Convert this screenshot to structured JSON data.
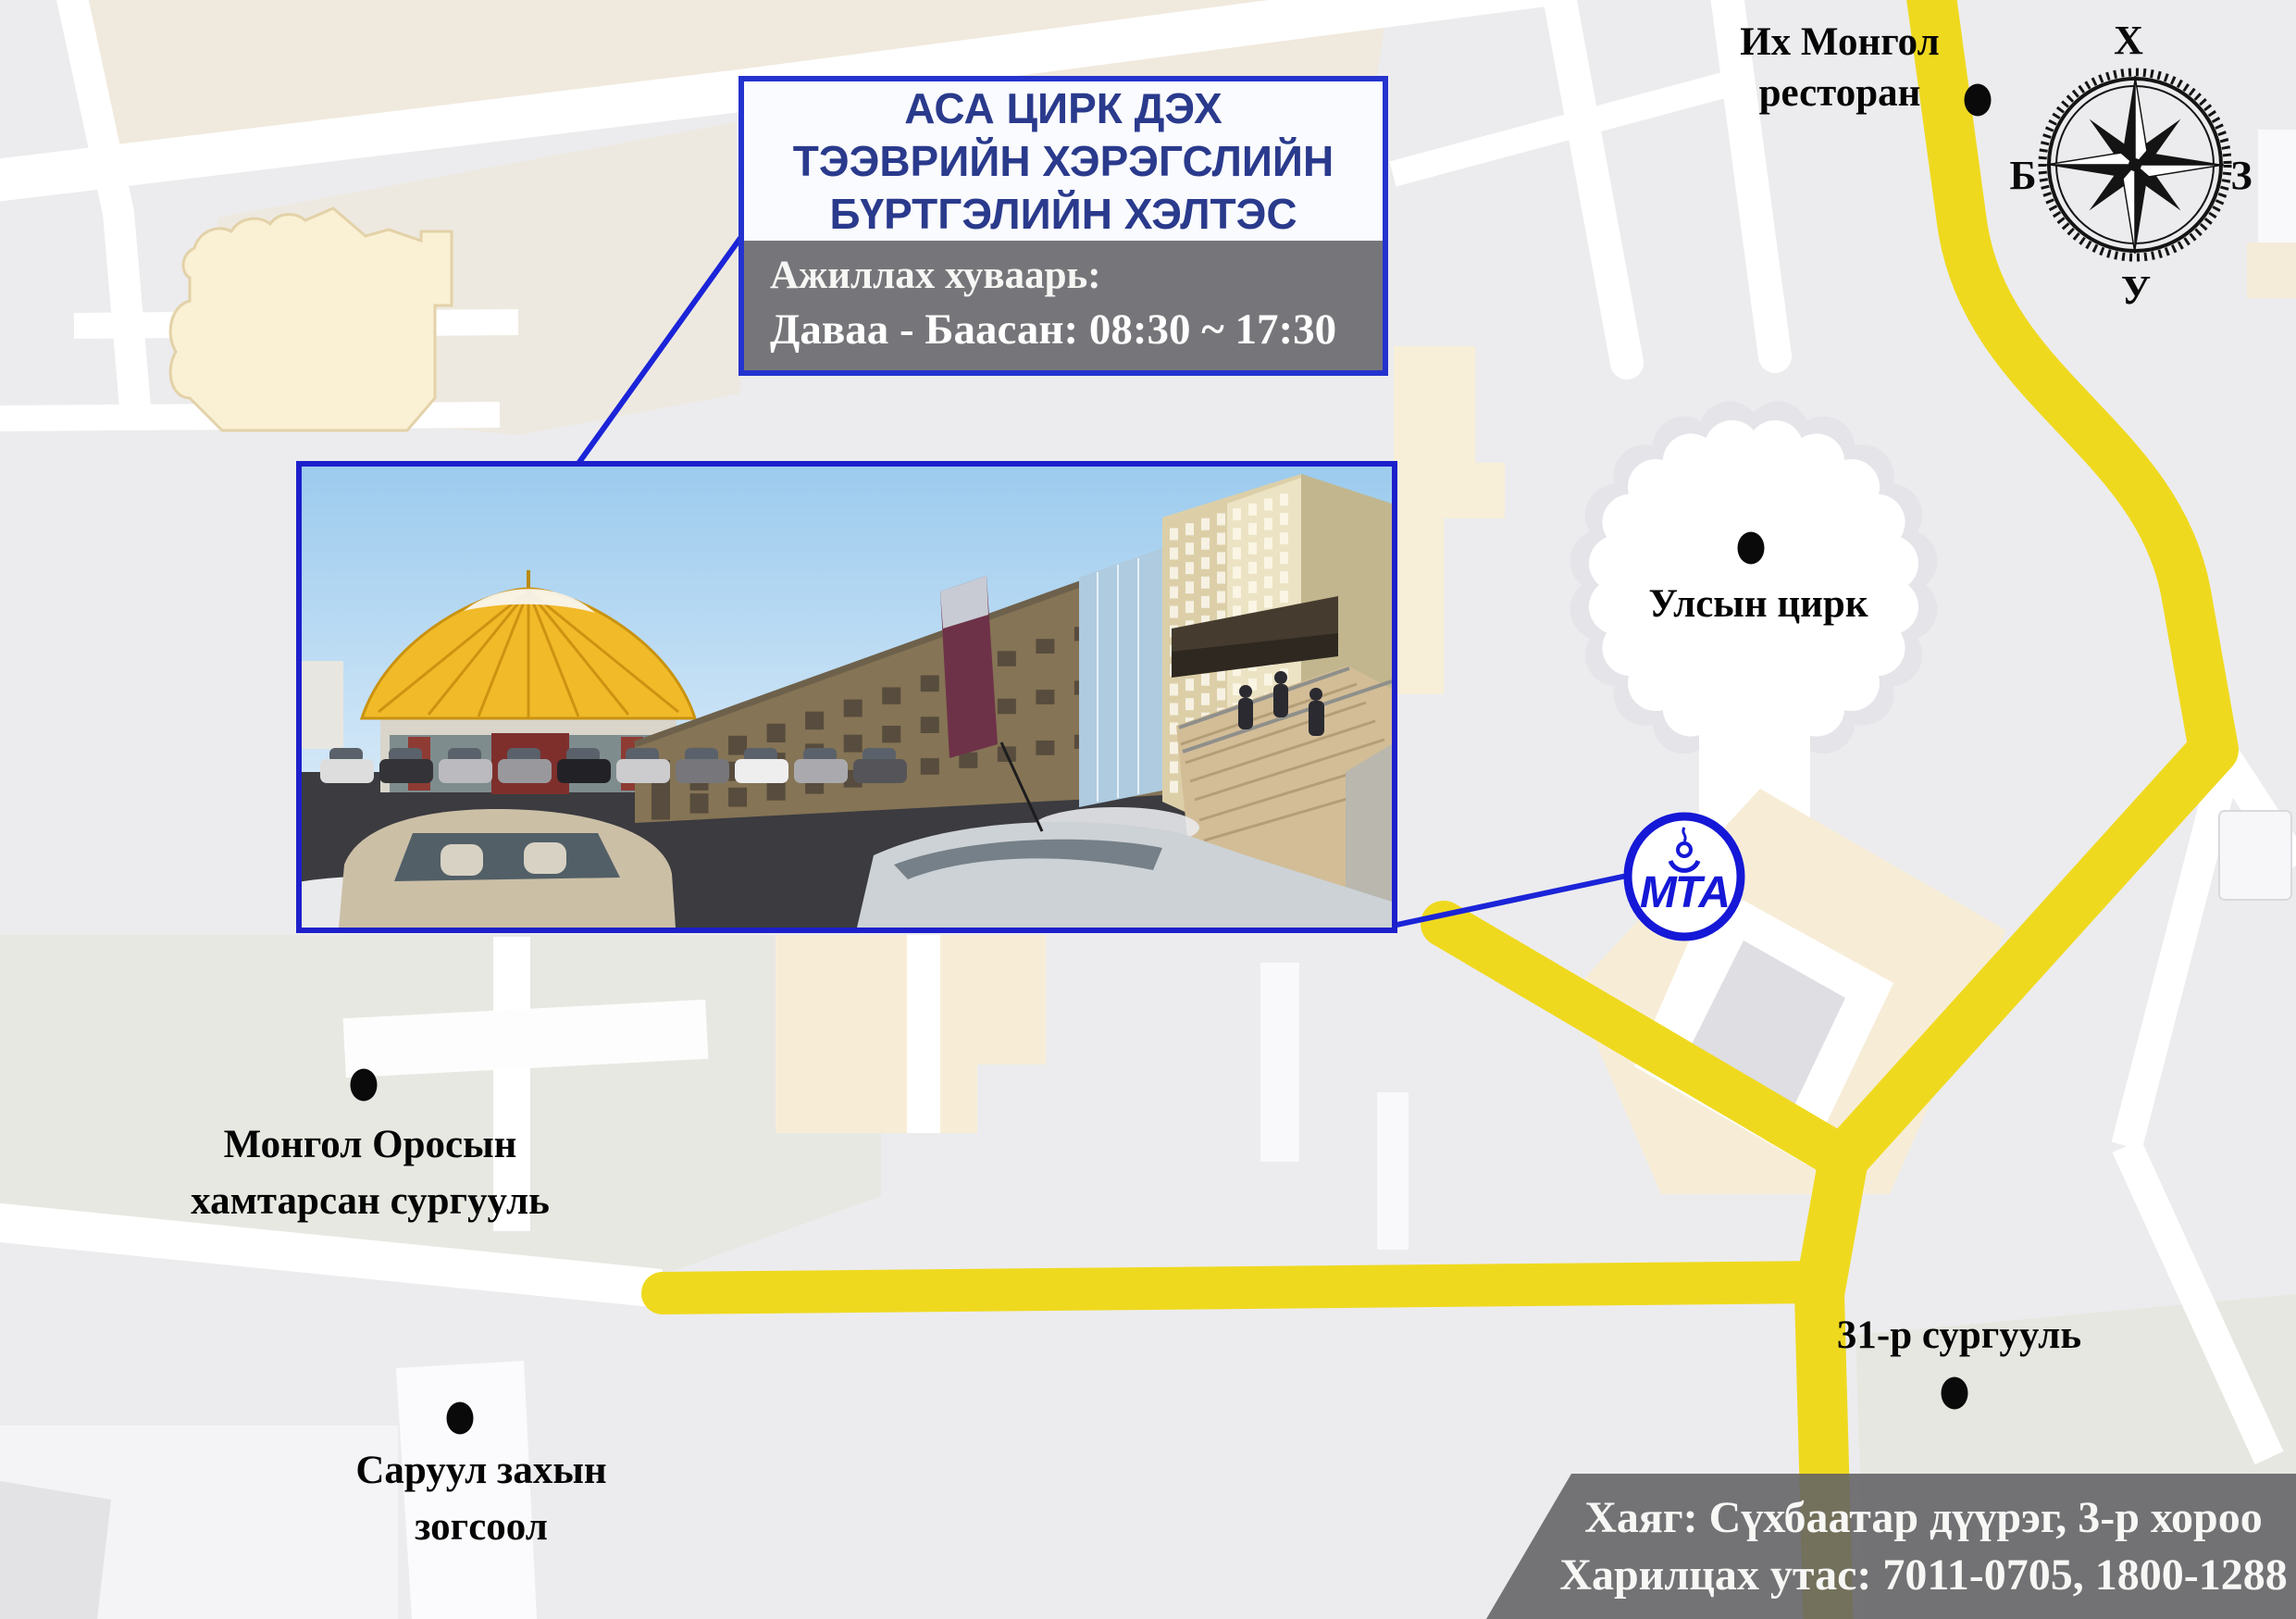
{
  "title_box": {
    "line1": "АСА ЦИРК ДЭХ",
    "line2": "ТЭЭВРИЙН ХЭРЭГСЛИЙН",
    "line3": "БҮРТГЭЛИЙН ХЭЛТЭС"
  },
  "hours_box": {
    "label": "Ажиллах хуваарь:",
    "value": "Даваа - Баасан: 08:30 ~ 17:30"
  },
  "address_box": {
    "line1": "Хаяг: Сүхбаатар дүүрэг, 3-р хороо",
    "line2": "Харилцах утас: 7011-0705, 1800-1288"
  },
  "map": {
    "labels": {
      "restaurant": {
        "line1": "Их Монгол",
        "line2": "ресторан"
      },
      "circus": {
        "line1": "Улсын цирк"
      },
      "school_ru": {
        "line1": "Монгол Оросын",
        "line2": "хамтарсан сургууль"
      },
      "parking": {
        "line1": "Саруул захын",
        "line2": "зогсоол"
      },
      "school31": {
        "line1": "31-р сургууль"
      }
    },
    "compass": {
      "top": "Х",
      "left": "Б",
      "right": "З",
      "bottom": "У"
    },
    "logo_text": "МТА",
    "colors": {
      "road_yellow": "#efd91f",
      "map_background": "#ececee",
      "accent_blue": "#2433ce",
      "box_gray": "#76767a"
    }
  },
  "photo": {
    "building_sign": "АВТО ТЭЭВРИЙН ҮНДЭСНИЙ ТӨВ"
  }
}
